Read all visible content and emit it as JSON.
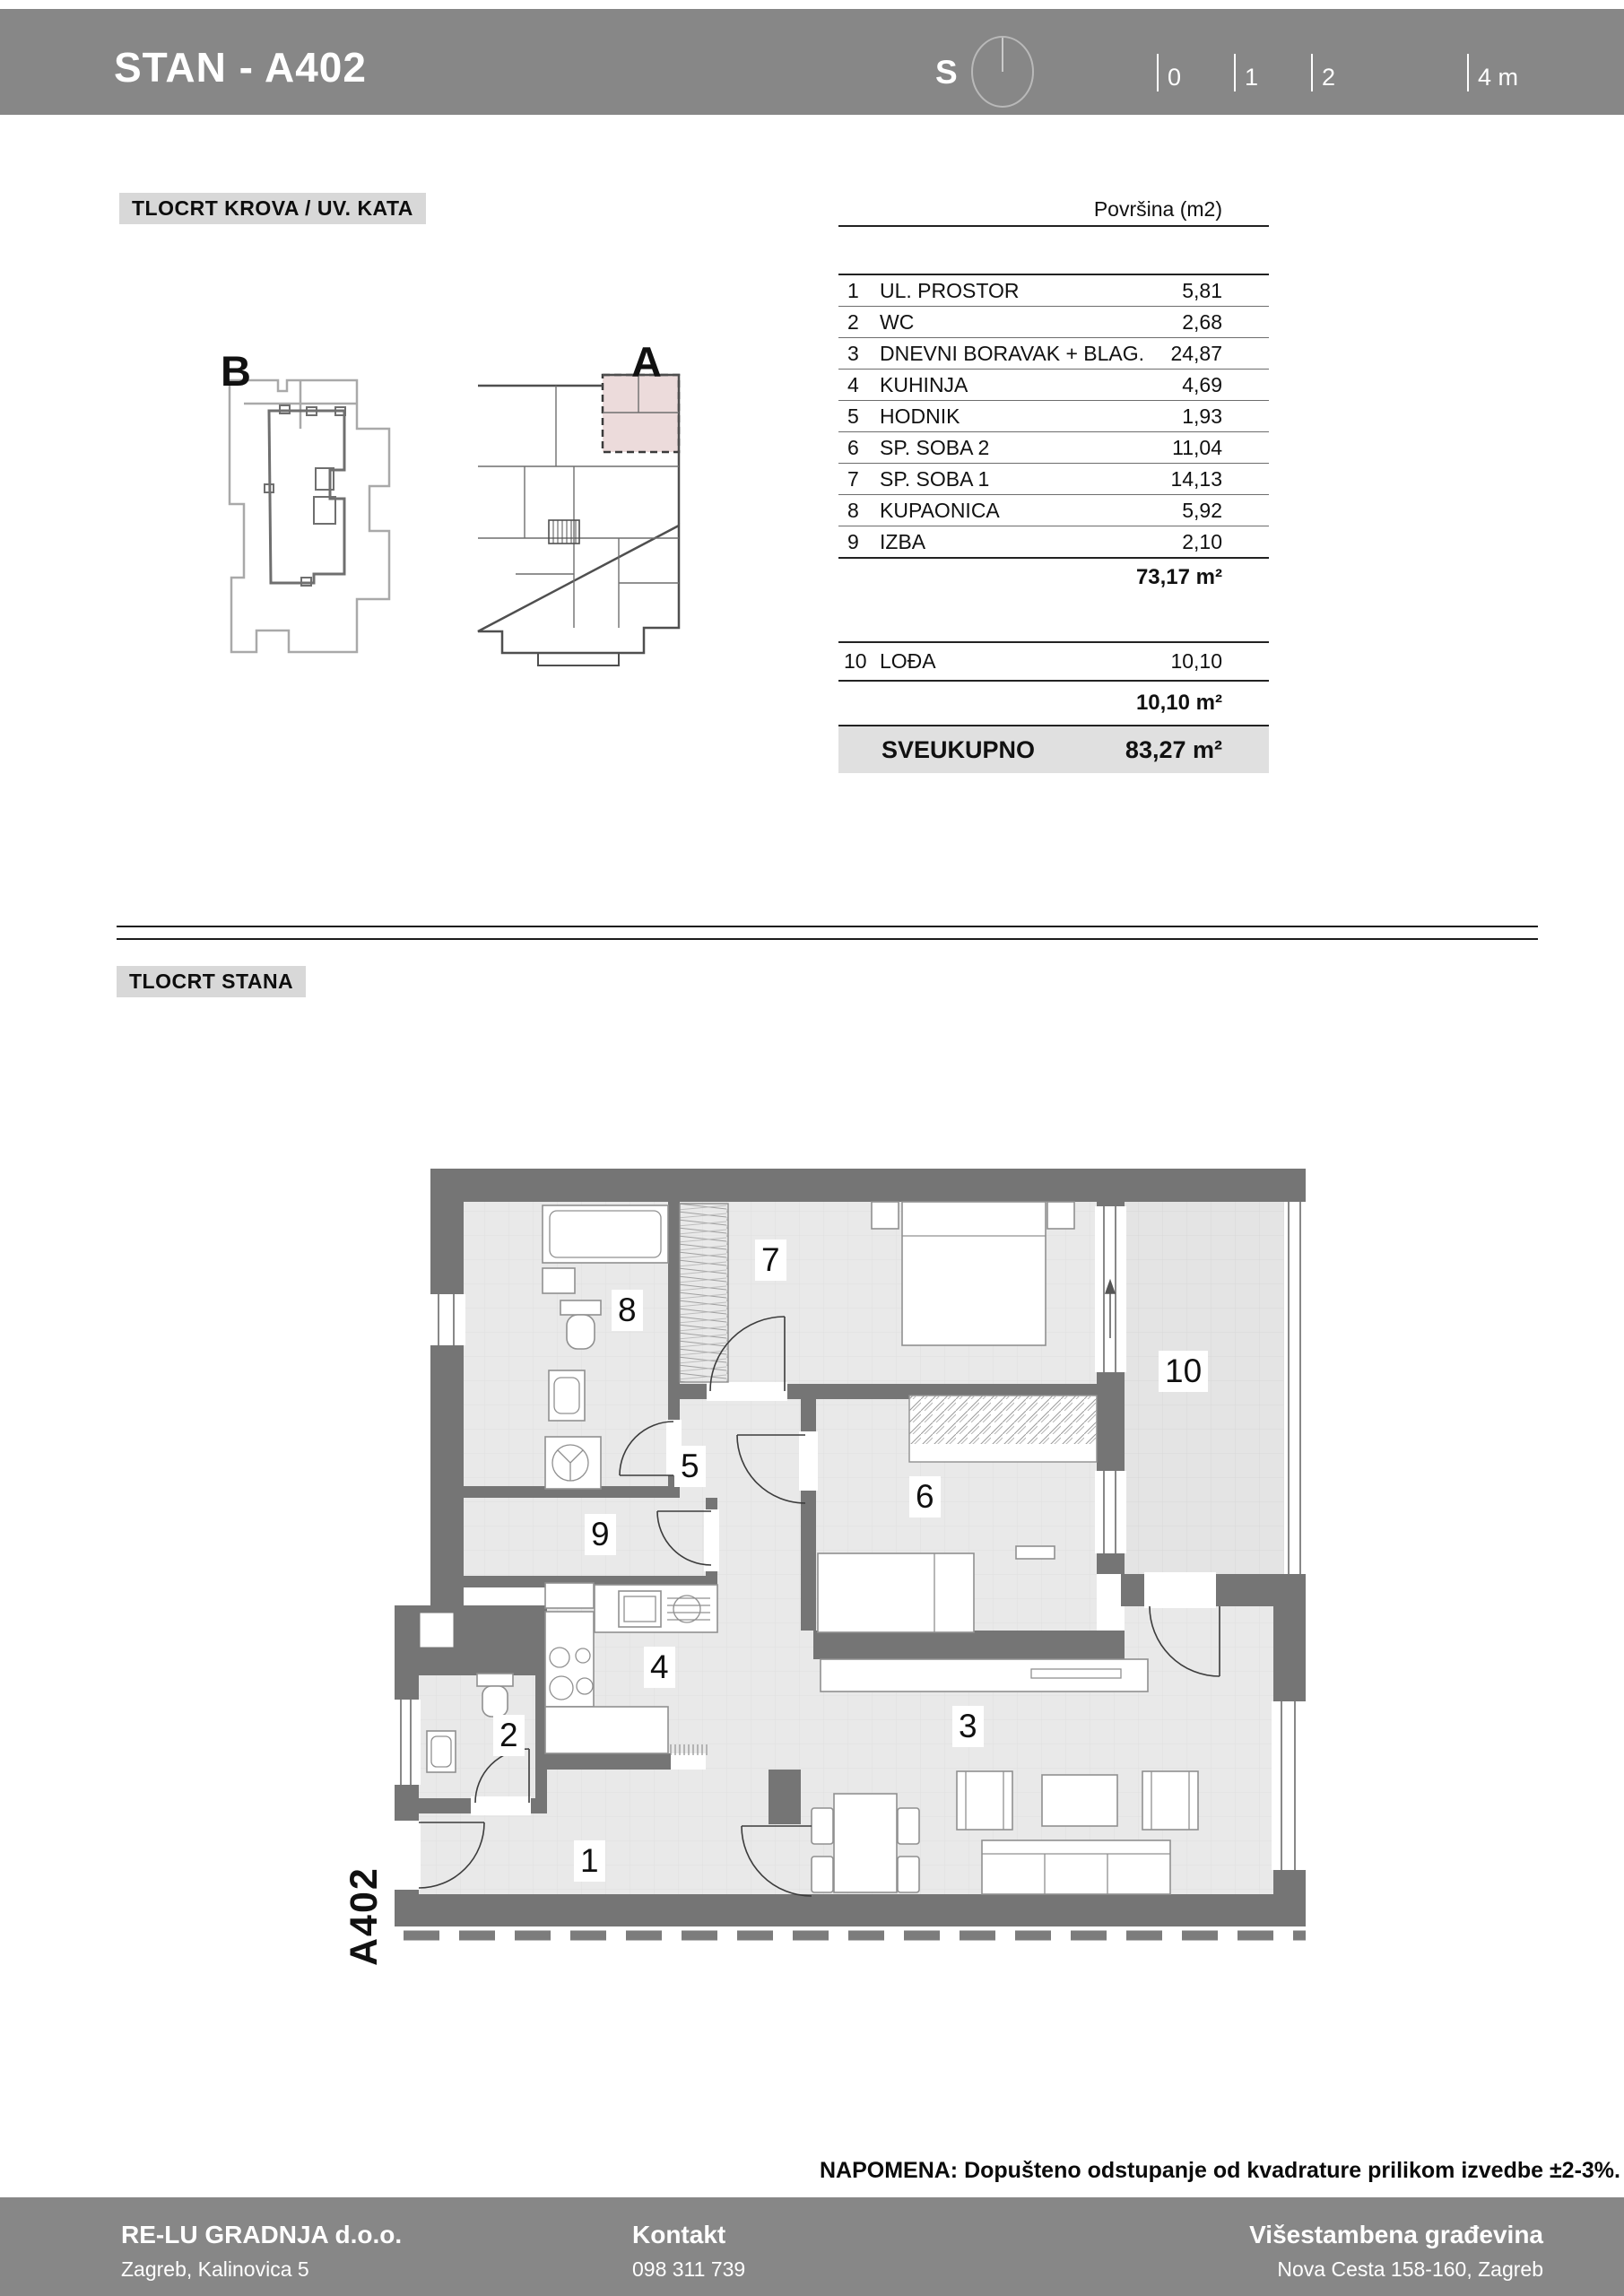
{
  "header": {
    "title": "STAN - A402",
    "compass": "S",
    "scale": {
      "t0": "0",
      "t1": "1",
      "t2": "2",
      "t4": "4 m"
    }
  },
  "sections": {
    "roof_label": "TLOCRT KROVA / UV. KATA",
    "plan_label": "TLOCRT STANA",
    "plan_b": "B",
    "plan_a": "A",
    "apartment_code": "A402"
  },
  "area_table": {
    "header": "Površina (m2)",
    "rows": [
      {
        "num": "1",
        "name": "UL. PROSTOR",
        "value": "5,81"
      },
      {
        "num": "2",
        "name": "WC",
        "value": "2,68"
      },
      {
        "num": "3",
        "name": "DNEVNI BORAVAK + BLAG.",
        "value": "24,87"
      },
      {
        "num": "4",
        "name": "KUHINJA",
        "value": "4,69"
      },
      {
        "num": "5",
        "name": "HODNIK",
        "value": "1,93"
      },
      {
        "num": "6",
        "name": "SP. SOBA 2",
        "value": "11,04"
      },
      {
        "num": "7",
        "name": "SP. SOBA 1",
        "value": "14,13"
      },
      {
        "num": "8",
        "name": "KUPAONICA",
        "value": "5,92"
      },
      {
        "num": "9",
        "name": "IZBA",
        "value": "2,10"
      }
    ],
    "subtotal": "73,17 m²",
    "row10": {
      "num": "10",
      "name": "LOĐA",
      "value": "10,10"
    },
    "subtotal10": "10,10 m²",
    "total_label": "SVEUKUPNO",
    "total_value": "83,27 m²"
  },
  "plan": {
    "room_labels": [
      "1",
      "2",
      "3",
      "4",
      "5",
      "6",
      "7",
      "8",
      "9",
      "10"
    ]
  },
  "note": "NAPOMENA: Dopušteno odstupanje od kvadrature prilikom izvedbe ±2-3%.",
  "footer": {
    "company": "RE-LU GRADNJA d.o.o.",
    "address": "Zagreb, Kalinovica 5",
    "contact_label": "Kontakt",
    "phone": "098 311 739",
    "project": "Višestambena građevina",
    "project_address": "Nova Cesta 158-160, Zagreb"
  },
  "colors": {
    "bar": "#878787",
    "badge_bg": "#d8d8d8",
    "total_row_bg": "#e0e0e0",
    "wall": "#757575",
    "floor": "#e9e9e9",
    "highlight": "#ecdbdb"
  }
}
